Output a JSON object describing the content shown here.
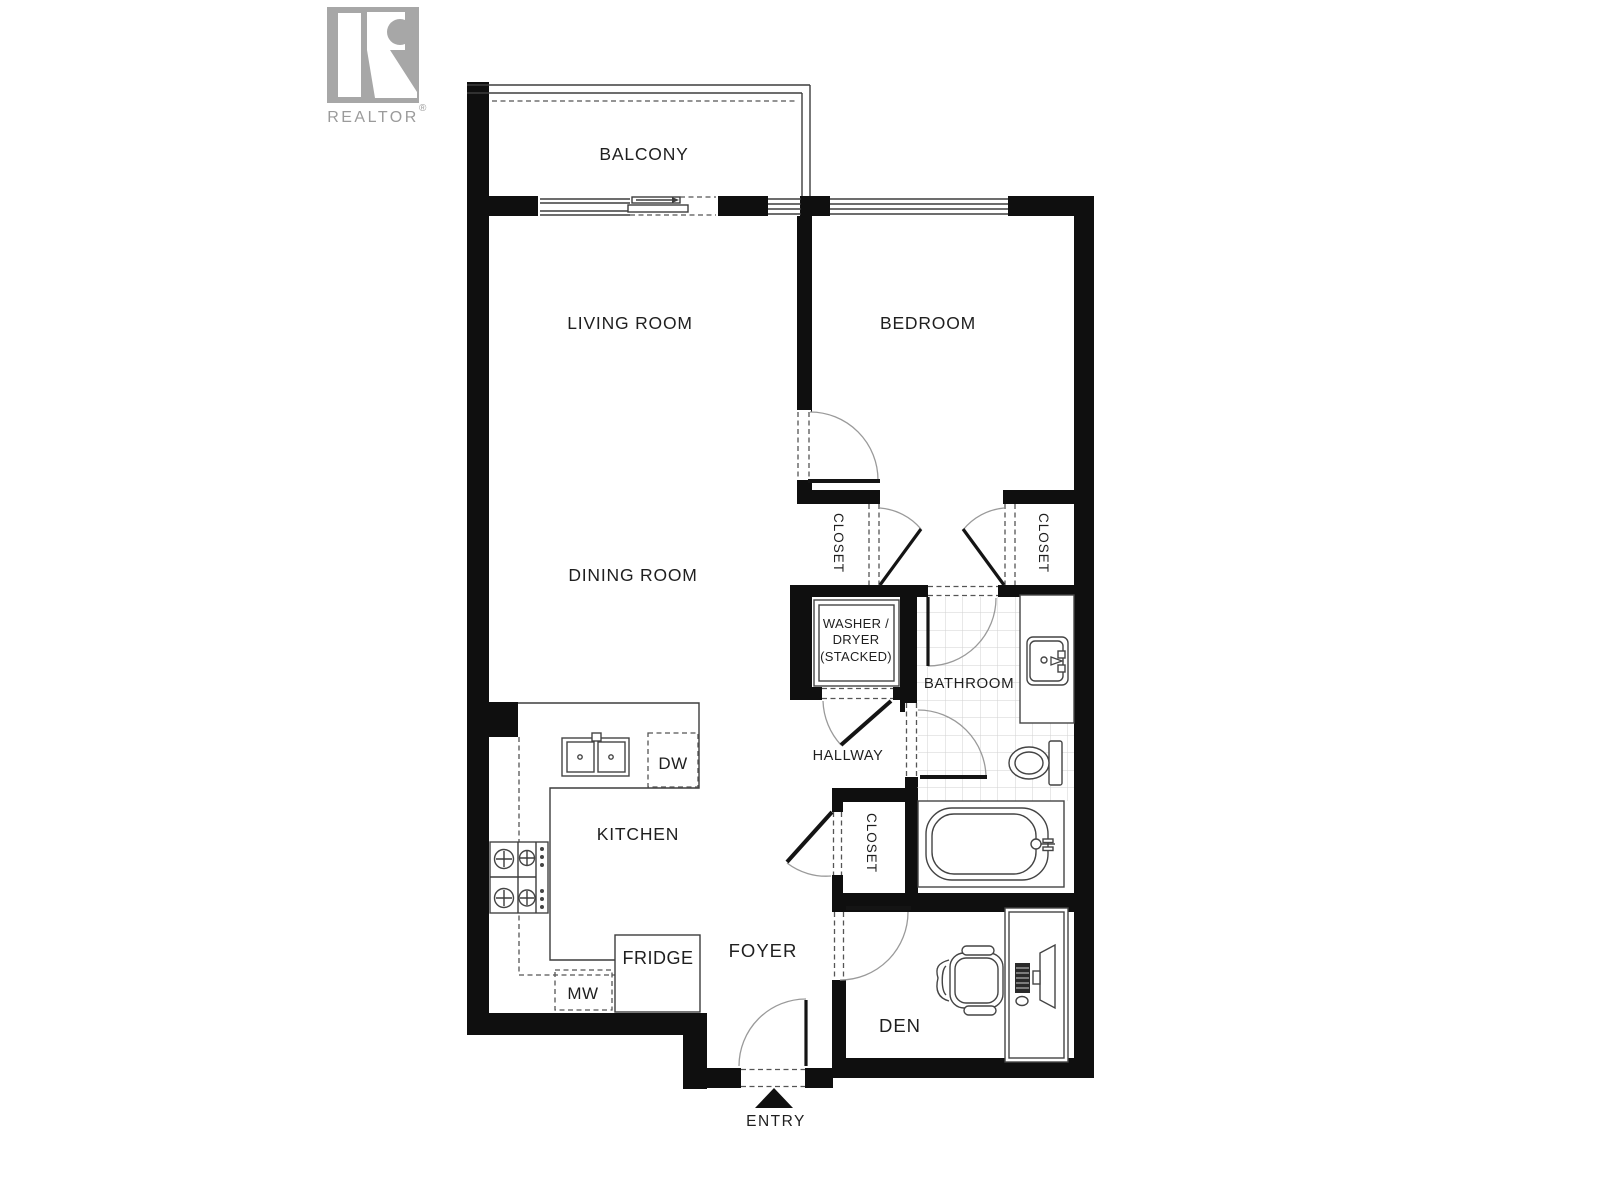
{
  "branding": {
    "logo_letter": "R",
    "brand_name": "REALTOR",
    "registered_symbol": "®"
  },
  "floor_plan": {
    "rooms": {
      "balcony": "BALCONY",
      "living_room": "LIVING ROOM",
      "bedroom": "BEDROOM",
      "dining_room": "DINING ROOM",
      "kitchen": "KITCHEN",
      "bathroom": "BATHROOM",
      "hallway": "HALLWAY",
      "foyer": "FOYER",
      "den": "DEN"
    },
    "closets": {
      "bedroom_left": "CLOSET",
      "bedroom_right": "CLOSET",
      "foyer_closet": "CLOSET"
    },
    "appliances": {
      "washer_dryer": [
        "WASHER /",
        "DRYER",
        "(STACKED)"
      ],
      "dishwasher": "DW",
      "fridge": "FRIDGE",
      "microwave": "MW"
    },
    "entry_label": "ENTRY"
  },
  "colors": {
    "wall": "#0f0f0f",
    "thin_line": "#3d3d3d",
    "door_arc": "#9a9a9a",
    "dashed_line": "#555555",
    "tile_line": "#d2d2d2",
    "label_text": "#1f1f1f",
    "logo_gray": "#a7a7a7",
    "brand_text": "#9b9b9b",
    "background": "#ffffff"
  }
}
